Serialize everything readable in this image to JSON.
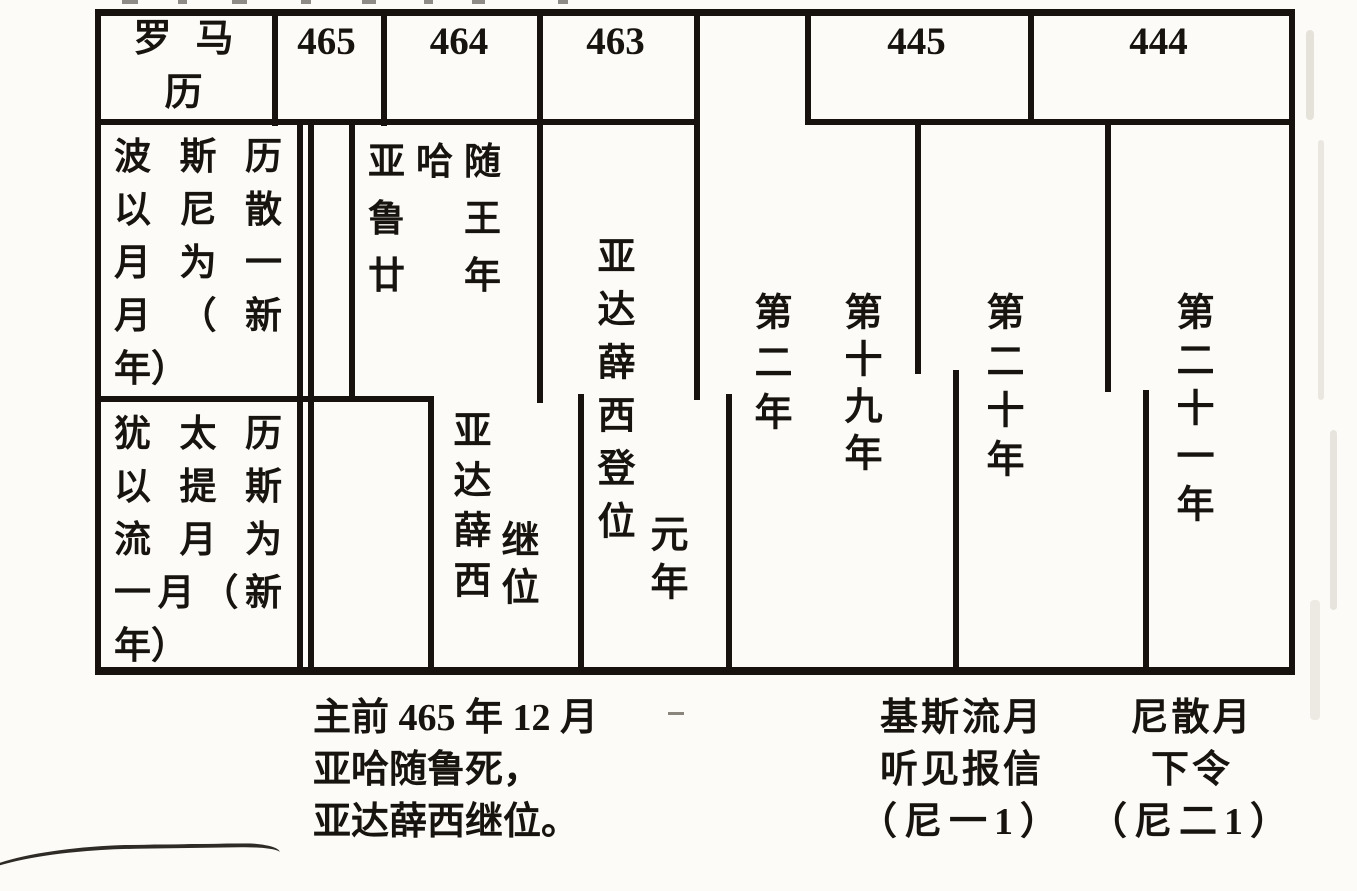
{
  "table": {
    "roman": {
      "label_lines": [
        "罗马",
        "历"
      ],
      "years": [
        "465",
        "464",
        "463",
        "445",
        "444"
      ]
    },
    "persian": {
      "label_lines": [
        "波斯历",
        "以尼散",
        "月为一",
        "月（新",
        "年）"
      ],
      "ahasuerus_year20_lines": [
        "亚哈随",
        "鲁王",
        "廿年"
      ],
      "artaxerxes_accession": {
        "main": "亚达薛西登位",
        "suffix": "元年"
      }
    },
    "jewish": {
      "label_lines": [
        "犹太历",
        "以提斯",
        "流月为",
        "一月（新",
        "年）"
      ],
      "artaxerxes_succession": {
        "main": "亚达薛西",
        "suffix": "继位"
      }
    },
    "regnal_year_markers": [
      "第二年",
      "第十九年",
      "第二十年",
      "第二十一年"
    ]
  },
  "captions": {
    "accession_note_lines": [
      "主前 465 年 12 月",
      "亚哈随鲁死，",
      "亚达薛西继位。"
    ],
    "kislev_note_lines": [
      "基斯流月",
      "听见报信",
      "（尼一1）"
    ],
    "nisan_note_lines": [
      "尼散月",
      "下令",
      "（尼二1）"
    ]
  },
  "colors": {
    "ink": "#17120e",
    "paper": "#fcfbf7"
  }
}
